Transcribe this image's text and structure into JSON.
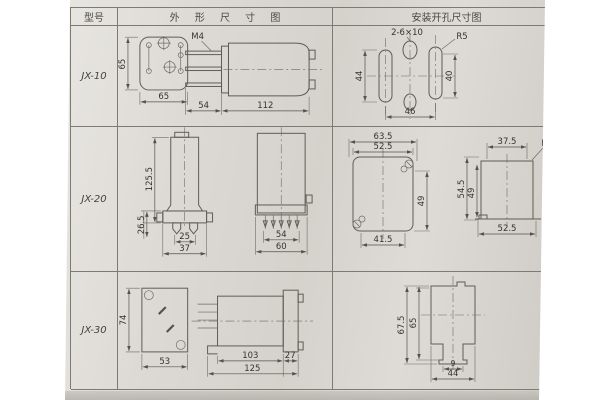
{
  "colors": {
    "paper": "#d8d5cf",
    "table_line": "#7d7a72",
    "drawing_line": "#5f5c55",
    "text": "#3a3835"
  },
  "header": {
    "model": "型号",
    "outline": "外 形 尺 寸 图",
    "mounting": "安装开孔尺寸图"
  },
  "rows": [
    {
      "model": "JX-10",
      "outline": {
        "front_h": "65",
        "front_w": "65",
        "thread": "M4",
        "blade_len": "54",
        "body_len": "112"
      },
      "mounting": {
        "slots": "2-6×10",
        "radius": "R5",
        "left_h": "44",
        "right_h": "40",
        "span": "46"
      }
    },
    {
      "model": "JX-20",
      "outline": {
        "total_h": "125.5",
        "base_h": "26.5",
        "pin_span": "25",
        "front_w": "37",
        "side_inner_w": "54",
        "side_w": "60"
      },
      "mounting": {
        "f1_w1": "63.5",
        "f1_w2": "52.5",
        "f1_h": "49",
        "f1_w3": "41.5",
        "f2_w1": "37.5",
        "f2_r": "R2.5",
        "f2_h1": "54.5",
        "f2_h2": "49",
        "f2_w2": "52.5"
      }
    },
    {
      "model": "JX-30",
      "outline": {
        "front_h": "74",
        "front_w": "53",
        "body_len": "103",
        "flange_len": "27",
        "total_len": "125"
      },
      "mounting": {
        "outer_h": "67.5",
        "inner_h": "65",
        "tab_w": "9",
        "span": "44"
      }
    }
  ]
}
